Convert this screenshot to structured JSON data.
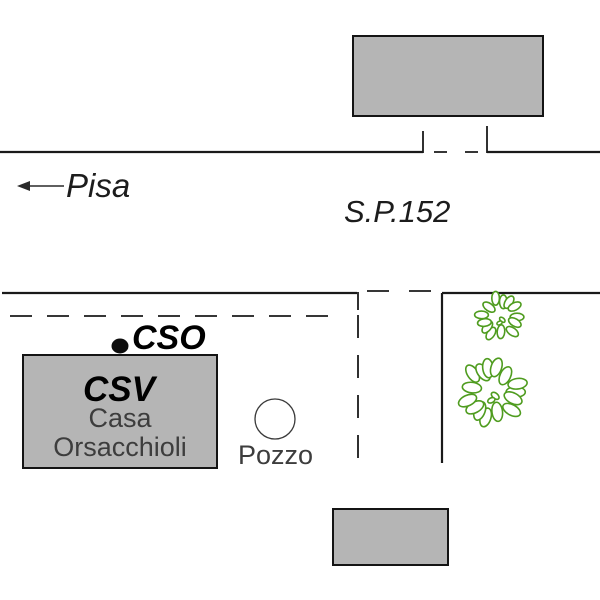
{
  "map": {
    "title": "Location sketch map",
    "road_label": "S.P.152",
    "direction_label": "Pisa",
    "cso_label": "CSO",
    "csv_label": "CSV",
    "building_name_line1": "Casa",
    "building_name_line2": "Orsacchioli",
    "well_label": "Pozzo",
    "colors": {
      "line": "#1a1a1a",
      "building_fill": "#b5b5b5",
      "vegetation": "#4f9c1f",
      "marker_black": "#0d0d0d"
    }
  }
}
